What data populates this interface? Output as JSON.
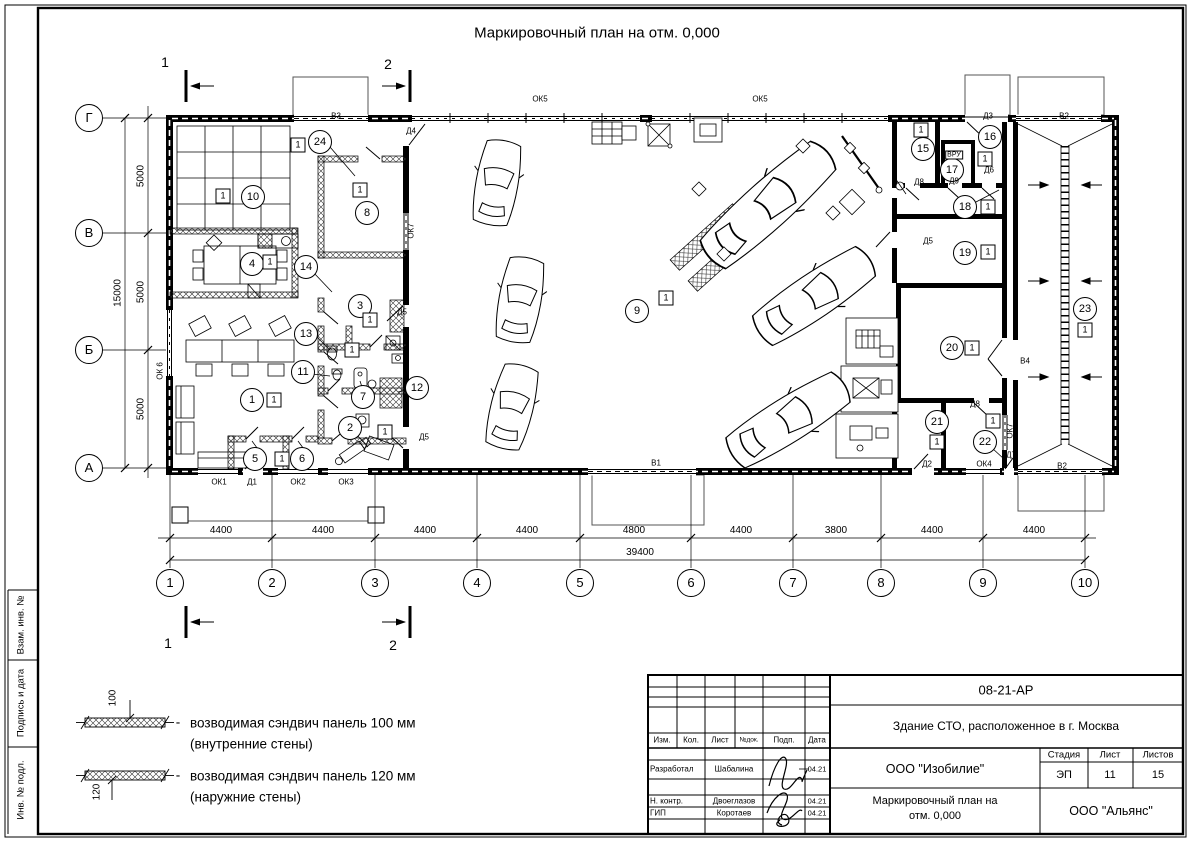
{
  "title": "Маркировочный план на отм. 0,000",
  "sidebar": {
    "labels": [
      "Взам. инв. №",
      "Подпись и дата",
      "Инв. № подл."
    ]
  },
  "section_marks": [
    {
      "label": "1",
      "x": 165,
      "y": 62
    },
    {
      "label": "2",
      "x": 388,
      "y": 64
    },
    {
      "label": "1",
      "x": 168,
      "y": 643
    },
    {
      "label": "2",
      "x": 393,
      "y": 645
    }
  ],
  "axes": {
    "bottom": [
      {
        "label": "1",
        "x": 170
      },
      {
        "label": "2",
        "x": 272
      },
      {
        "label": "3",
        "x": 375
      },
      {
        "label": "4",
        "x": 477
      },
      {
        "label": "5",
        "x": 580
      },
      {
        "label": "6",
        "x": 691
      },
      {
        "label": "7",
        "x": 793
      },
      {
        "label": "8",
        "x": 881
      },
      {
        "label": "9",
        "x": 983
      },
      {
        "label": "10",
        "x": 1085
      }
    ],
    "left": [
      {
        "label": "Г",
        "y": 118
      },
      {
        "label": "В",
        "y": 233
      },
      {
        "label": "Б",
        "y": 350
      },
      {
        "label": "А",
        "y": 468
      }
    ]
  },
  "dims": {
    "bottom": [
      {
        "text": "4400",
        "x": 221
      },
      {
        "text": "4400",
        "x": 323
      },
      {
        "text": "4400",
        "x": 425
      },
      {
        "text": "4400",
        "x": 527
      },
      {
        "text": "4800",
        "x": 634
      },
      {
        "text": "4400",
        "x": 741
      },
      {
        "text": "3800",
        "x": 836
      },
      {
        "text": "4400",
        "x": 932
      },
      {
        "text": "4400",
        "x": 1034
      }
    ],
    "bottom_total": {
      "text": "39400",
      "x": 640,
      "y": 558
    },
    "left": [
      {
        "text": "5000",
        "y": 176
      },
      {
        "text": "5000",
        "y": 292
      },
      {
        "text": "5000",
        "y": 409
      }
    ],
    "left_total": {
      "text": "15000",
      "x": 118,
      "y": 293
    }
  },
  "rooms": [
    {
      "n": "1",
      "x": 252,
      "y": 400
    },
    {
      "n": "2",
      "x": 350,
      "y": 428
    },
    {
      "n": "3",
      "x": 360,
      "y": 306
    },
    {
      "n": "4",
      "x": 252,
      "y": 264
    },
    {
      "n": "5",
      "x": 255,
      "y": 459
    },
    {
      "n": "6",
      "x": 302,
      "y": 459
    },
    {
      "n": "7",
      "x": 363,
      "y": 397
    },
    {
      "n": "8",
      "x": 367,
      "y": 213
    },
    {
      "n": "9",
      "x": 637,
      "y": 311
    },
    {
      "n": "10",
      "x": 253,
      "y": 197
    },
    {
      "n": "11",
      "x": 303,
      "y": 372
    },
    {
      "n": "12",
      "x": 417,
      "y": 388
    },
    {
      "n": "13",
      "x": 306,
      "y": 334
    },
    {
      "n": "14",
      "x": 306,
      "y": 267
    },
    {
      "n": "15",
      "x": 923,
      "y": 149
    },
    {
      "n": "16",
      "x": 990,
      "y": 137
    },
    {
      "n": "17",
      "x": 952,
      "y": 170
    },
    {
      "n": "18",
      "x": 965,
      "y": 207
    },
    {
      "n": "19",
      "x": 965,
      "y": 253
    },
    {
      "n": "20",
      "x": 952,
      "y": 348
    },
    {
      "n": "21",
      "x": 937,
      "y": 422
    },
    {
      "n": "22",
      "x": 985,
      "y": 442
    },
    {
      "n": "23",
      "x": 1085,
      "y": 309
    },
    {
      "n": "24",
      "x": 320,
      "y": 142
    }
  ],
  "wall_marks": [
    {
      "t": "1",
      "x": 274,
      "y": 400
    },
    {
      "t": "1",
      "x": 385,
      "y": 432
    },
    {
      "t": "1",
      "x": 370,
      "y": 320
    },
    {
      "t": "1",
      "x": 270,
      "y": 262
    },
    {
      "t": "1",
      "x": 282,
      "y": 459
    },
    {
      "t": "1",
      "x": 352,
      "y": 350
    },
    {
      "t": "1",
      "x": 666,
      "y": 298
    },
    {
      "t": "1",
      "x": 223,
      "y": 196
    },
    {
      "t": "1",
      "x": 298,
      "y": 145
    },
    {
      "t": "1",
      "x": 360,
      "y": 190
    },
    {
      "t": "1",
      "x": 921,
      "y": 130
    },
    {
      "t": "1",
      "x": 985,
      "y": 159
    },
    {
      "t": "1",
      "x": 988,
      "y": 207
    },
    {
      "t": "1",
      "x": 988,
      "y": 252
    },
    {
      "t": "1",
      "x": 972,
      "y": 348
    },
    {
      "t": "1",
      "x": 937,
      "y": 442
    },
    {
      "t": "1",
      "x": 993,
      "y": 421
    },
    {
      "t": "1",
      "x": 1085,
      "y": 330
    }
  ],
  "plan_labels": [
    {
      "t": "ОК5",
      "x": 540,
      "y": 99
    },
    {
      "t": "ОК5",
      "x": 760,
      "y": 99
    },
    {
      "t": "В3",
      "x": 336,
      "y": 116
    },
    {
      "t": "Д4",
      "x": 411,
      "y": 131
    },
    {
      "t": "Д3",
      "x": 988,
      "y": 116
    },
    {
      "t": "В2",
      "x": 1064,
      "y": 116
    },
    {
      "t": "ОК 6",
      "x": 160,
      "y": 371,
      "r": -90
    },
    {
      "t": "ОК7",
      "x": 411,
      "y": 231,
      "r": -90
    },
    {
      "t": "ОК7",
      "x": 1010,
      "y": 431,
      "r": -90
    },
    {
      "t": "Д5",
      "x": 402,
      "y": 312
    },
    {
      "t": "Д5",
      "x": 424,
      "y": 437
    },
    {
      "t": "Д5",
      "x": 928,
      "y": 241
    },
    {
      "t": "ОК1",
      "x": 219,
      "y": 482
    },
    {
      "t": "Д1",
      "x": 252,
      "y": 482
    },
    {
      "t": "ОК2",
      "x": 298,
      "y": 482
    },
    {
      "t": "ОК3",
      "x": 346,
      "y": 482
    },
    {
      "t": "В1",
      "x": 656,
      "y": 463
    },
    {
      "t": "Д2",
      "x": 927,
      "y": 464
    },
    {
      "t": "ОК4",
      "x": 984,
      "y": 464
    },
    {
      "t": "Д7",
      "x": 1011,
      "y": 455
    },
    {
      "t": "В2",
      "x": 1062,
      "y": 466
    },
    {
      "t": "Д8",
      "x": 919,
      "y": 182
    },
    {
      "t": "Д9",
      "x": 954,
      "y": 181
    },
    {
      "t": "Д6",
      "x": 989,
      "y": 170
    },
    {
      "t": "Д8",
      "x": 975,
      "y": 404
    },
    {
      "t": "В4",
      "x": 1025,
      "y": 361
    },
    {
      "t": "ВРУ",
      "x": 954,
      "y": 155,
      "box": true
    }
  ],
  "legend": {
    "dash": "-",
    "items": [
      {
        "dim": "100",
        "text": "возводимая сэндвич панель 100 мм",
        "note": "(внутренние стены)"
      },
      {
        "dim": "120",
        "text": "возводимая сэндвич панель 120 мм",
        "note": "(наружние стены)"
      }
    ]
  },
  "titleblock": {
    "doc_code": "08-21-АР",
    "object": "Здание СТО, расположенное в г. Москва",
    "org": "ООО \"Изобилие\"",
    "drawing_name_1": "Маркировочный план на",
    "drawing_name_2": "отм. 0,000",
    "org2": "ООО \"Альянс\"",
    "cols": [
      "Изм.",
      "Кол.",
      "Лист",
      "№док.",
      "Подп.",
      "Дата"
    ],
    "stage_headers": [
      "Стадия",
      "Лист",
      "Листов"
    ],
    "stage_values": [
      "ЭП",
      "11",
      "15"
    ],
    "sign_rows": [
      {
        "role": "Разработал",
        "name": "Шабалина",
        "date": "04.21"
      },
      {
        "role": "Н. контр.",
        "name": "Двоеглазов",
        "date": "04.21"
      },
      {
        "role": "ГИП",
        "name": "Коротаев",
        "date": "04.21"
      }
    ]
  }
}
